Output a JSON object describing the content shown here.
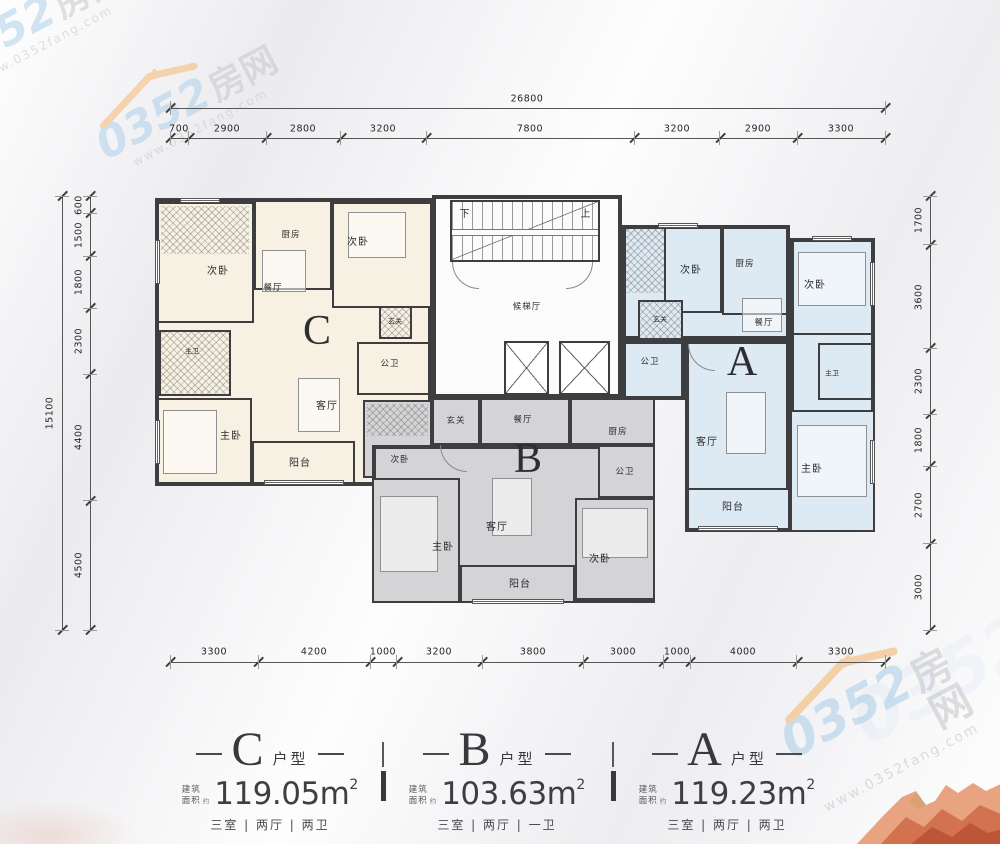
{
  "colors": {
    "wall": "#3e3e40",
    "unit_c_fill": "#f6f1e2",
    "unit_b_fill": "#d4d4d6",
    "unit_a_fill": "#dde9f3",
    "watermark_blue": "#a8cde8",
    "watermark_orange": "#f5b469",
    "mountain_red": "#c9603f",
    "dimension_text": "#262626"
  },
  "dimensions": {
    "top": {
      "total": "26800",
      "segments": [
        "700",
        "2900",
        "2800",
        "3200",
        "7800",
        "3200",
        "2900",
        "3300"
      ]
    },
    "bottom": {
      "segments": [
        "3300",
        "4200",
        "1000",
        "3200",
        "3800",
        "3000",
        "1000",
        "4000",
        "3300"
      ]
    },
    "left": {
      "total": "15100",
      "segments": [
        "600",
        "1500",
        "1800",
        "2300",
        "4400",
        "4500"
      ]
    },
    "right": {
      "segments": [
        "1700",
        "3600",
        "2300",
        "1800",
        "2700",
        "3000"
      ]
    }
  },
  "core": {
    "down": "下",
    "up": "上",
    "elevator_hall": "候梯厅"
  },
  "units": {
    "c": {
      "letter": "C",
      "bedroom_top_left": "次卧",
      "kitchen": "厨房",
      "bedroom_top_right": "次卧",
      "dining": "餐厅",
      "master_bath": "主卫",
      "entry": "玄关",
      "public_bath": "公卫",
      "master_bedroom": "主卧",
      "living": "客厅",
      "balcony": "阳台"
    },
    "b": {
      "letter": "B",
      "entry": "玄关",
      "dining": "餐厅",
      "kitchen": "厨房",
      "bedroom_left": "次卧",
      "public_bath": "公卫",
      "master_bedroom": "主卧",
      "living": "客厅",
      "balcony": "阳台",
      "bedroom_right": "次卧"
    },
    "a": {
      "letter": "A",
      "bedroom_top_left": "次卧",
      "kitchen": "厨房",
      "bedroom_top_right": "次卧",
      "dining": "餐厅",
      "entry": "玄关",
      "public_bath": "公卫",
      "master_bath": "主卫",
      "living": "客厅",
      "master_bedroom": "主卧",
      "balcony": "阳台"
    }
  },
  "legend": [
    {
      "letter": "C",
      "suffix": "户型",
      "area_label_top": "建筑",
      "area_label_bottom": "面积",
      "area_label_approx": "约",
      "area_value": "119.05m",
      "area_sup": "2",
      "rooms": "三室 | 两厅 | 两卫"
    },
    {
      "letter": "B",
      "suffix": "户型",
      "area_label_top": "建筑",
      "area_label_bottom": "面积",
      "area_label_approx": "约",
      "area_value": "103.63m",
      "area_sup": "2",
      "rooms": "三室 | 两厅 | 一卫"
    },
    {
      "letter": "A",
      "suffix": "户型",
      "area_label_top": "建筑",
      "area_label_bottom": "面积",
      "area_label_approx": "约",
      "area_value": "119.23m",
      "area_sup": "2",
      "rooms": "三室 | 两厅 | 两卫"
    }
  ],
  "watermark": {
    "number": "0352",
    "brand": "房网",
    "url": "www.0352fang.com"
  }
}
